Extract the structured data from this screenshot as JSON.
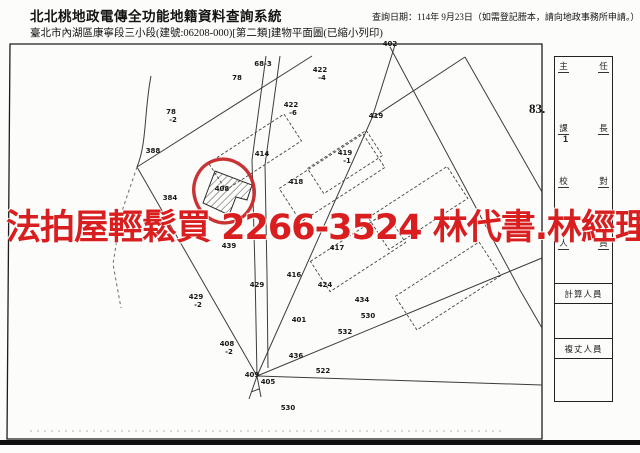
{
  "header": {
    "system_title": "北北桃地政電傳全功能地籍資料查詢系統",
    "query_date": "查詢日期：114年 9月23日（如需登記謄本，請向地政事務所申請。）",
    "document_line": "臺北市內湖區康寧段三小段(建號:06208-000)[第二類]建物平面圖(已縮小列印)"
  },
  "watermark": {
    "text": "法拍屋輕鬆買  2266-3524  林代書.林經理",
    "color": "#d81e1e"
  },
  "map": {
    "circle_color": "#c62828",
    "labels": [
      {
        "text": "402",
        "x": 390,
        "y": 46
      },
      {
        "text": "68-3",
        "x": 263,
        "y": 66
      },
      {
        "text": "78",
        "x": 237,
        "y": 80
      },
      {
        "text": "422",
        "x": 320,
        "y": 72
      },
      {
        "text": "-4",
        "x": 322,
        "y": 80
      },
      {
        "text": "422",
        "x": 291,
        "y": 107
      },
      {
        "text": "-6",
        "x": 293,
        "y": 115
      },
      {
        "text": "419",
        "x": 376,
        "y": 118
      },
      {
        "text": "78",
        "x": 171,
        "y": 114
      },
      {
        "text": "-2",
        "x": 173,
        "y": 122
      },
      {
        "text": "388",
        "x": 153,
        "y": 153
      },
      {
        "text": "414",
        "x": 262,
        "y": 156
      },
      {
        "text": "419",
        "x": 345,
        "y": 155
      },
      {
        "text": "-1",
        "x": 347,
        "y": 163
      },
      {
        "text": "418",
        "x": 296,
        "y": 184
      },
      {
        "text": "384",
        "x": 170,
        "y": 200
      },
      {
        "text": "408",
        "x": 222,
        "y": 191
      },
      {
        "text": "439",
        "x": 229,
        "y": 248
      },
      {
        "text": "417",
        "x": 337,
        "y": 250
      },
      {
        "text": "416",
        "x": 294,
        "y": 277
      },
      {
        "text": "429",
        "x": 257,
        "y": 287
      },
      {
        "text": "424",
        "x": 325,
        "y": 287
      },
      {
        "text": "429",
        "x": 196,
        "y": 299
      },
      {
        "text": "-2",
        "x": 198,
        "y": 307
      },
      {
        "text": "434",
        "x": 362,
        "y": 302
      },
      {
        "text": "401",
        "x": 299,
        "y": 322
      },
      {
        "text": "530",
        "x": 368,
        "y": 318
      },
      {
        "text": "532",
        "x": 345,
        "y": 334
      },
      {
        "text": "408",
        "x": 227,
        "y": 346
      },
      {
        "text": "-2",
        "x": 229,
        "y": 354
      },
      {
        "text": "436",
        "x": 296,
        "y": 358
      },
      {
        "text": "522",
        "x": 323,
        "y": 373
      },
      {
        "text": "409",
        "x": 252,
        "y": 377
      },
      {
        "text": "405",
        "x": 268,
        "y": 384
      },
      {
        "text": "530",
        "x": 288,
        "y": 410
      }
    ]
  },
  "sidebar": {
    "sheet_number": "83.",
    "role_pairs": [
      [
        "主",
        "任"
      ],
      [
        "課",
        "長"
      ],
      [
        "校",
        "對"
      ],
      [
        "人",
        "員"
      ]
    ],
    "stamp_mark": "1",
    "row_labels": [
      "計算人員",
      "複丈人員"
    ]
  }
}
